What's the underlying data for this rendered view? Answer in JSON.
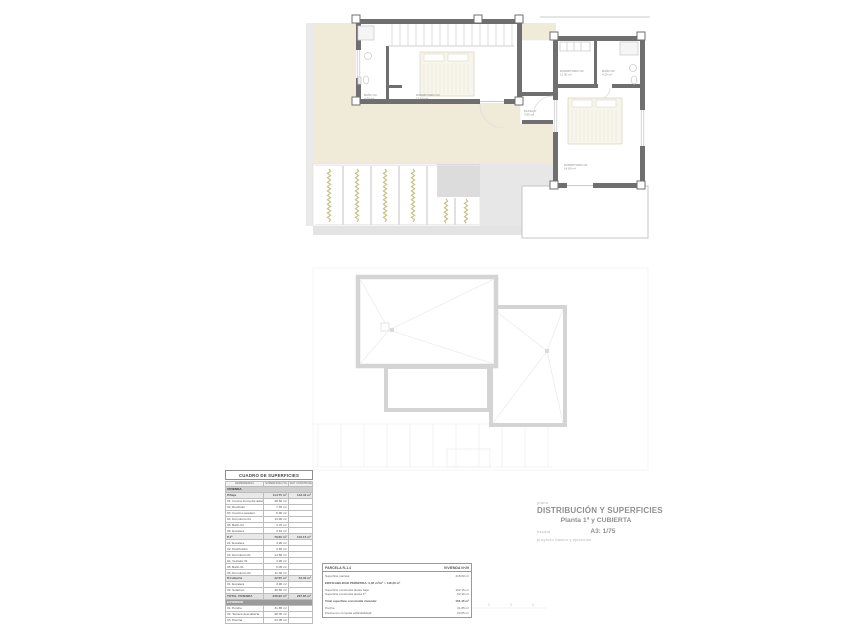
{
  "colors": {
    "wall_gray": "#6f6f6f",
    "terrace_beige": "#f0ebd9",
    "deck_gray": "#e3e3e3",
    "pergola_olive": "#c1bf7e",
    "roof_outline": "#d4d4d4",
    "text_gray": "#8f8f8f"
  },
  "floor_plan": {
    "labels": [
      {
        "text": "BAÑO 03",
        "area": "4.30 m²"
      },
      {
        "text": "DORMITORIO 03",
        "area": "12.60 m²"
      },
      {
        "text": "PASILLO",
        "area": "3.65 m²"
      },
      {
        "text": "DORMITORIO 02",
        "area": "11.30 m²"
      },
      {
        "text": "BAÑO 02",
        "area": "4.25 m²"
      },
      {
        "text": "DORMITORIO 01",
        "area": "14.80 m²"
      }
    ]
  },
  "scale_bar": {
    "ticks": [
      "1",
      "2",
      "3",
      "4"
    ]
  },
  "surfaces_table": {
    "title": "CUADRO DE SUPERFICIES",
    "col_dependencia": "DEPENDENCIA",
    "col_util": "SUPERFICIE ÚTIL",
    "col_construida": "SUP. CONSTRUIDA",
    "section_vivienda": "VIVIENDA",
    "rows": [
      {
        "label": "P.Baja",
        "util": "114.75 m²",
        "cons": "133.40 m²"
      },
      {
        "label": "01. Cocina-Comedor-Estar",
        "util": "48.60 m²",
        "cons": ""
      },
      {
        "label": "02. Recibidor",
        "util": "7.45 m²",
        "cons": ""
      },
      {
        "label": "03. Cuarto Lavadero",
        "util": "6.90 m²",
        "cons": ""
      },
      {
        "label": "04. Dormitorio 04",
        "util": "13.90 m²",
        "cons": ""
      },
      {
        "label": "05. Baño 04",
        "util": "4.70 m²",
        "cons": ""
      },
      {
        "label": "06. Escalera",
        "util": "4.10 m²",
        "cons": ""
      },
      {
        "label": "P.1ª",
        "util": "79.60 m²",
        "cons": "102.15 m²"
      },
      {
        "label": "01. Escalera",
        "util": "3.90 m²",
        "cons": ""
      },
      {
        "label": "02. Distribuidor",
        "util": "4.65 m²",
        "cons": ""
      },
      {
        "label": "03. Dormitorio 01",
        "util": "14.80 m²",
        "cons": ""
      },
      {
        "label": "04. Vestidor 01",
        "util": "4.90 m²",
        "cons": ""
      },
      {
        "label": "05. Baño 01",
        "util": "5.05 m²",
        "cons": ""
      },
      {
        "label": "06. Dormitorio 02",
        "util": "11.30 m²",
        "cons": ""
      },
      {
        "label": "P.Cubierta",
        "util": "42.55 m²",
        "cons": "52.30 m²"
      },
      {
        "label": "01. Escalera",
        "util": "3.90 m²",
        "cons": ""
      },
      {
        "label": "02. Solárium",
        "util": "38.65 m²",
        "cons": ""
      }
    ],
    "total_label": "TOTAL VIVIENDA",
    "total_util": "236.90 m²",
    "total_cons": "287.85 m²",
    "section_exterior": "EXTERIOR",
    "exterior_rows": [
      {
        "label": "01. Porche",
        "util": "31.85 m²"
      },
      {
        "label": "02. Terraza descubierta",
        "util": "48.35 m²"
      },
      {
        "label": "03. Piscina",
        "util": "23.05 m²"
      }
    ]
  },
  "parcel_table": {
    "parcela": "PARCELA R-1.4",
    "vivienda": "VIVIENDA Nº29",
    "parcela_row": {
      "label": "Superficie parcela:",
      "value": "418.00 m²"
    },
    "edificabilidad": "EDIFICABILIDAD PERMITIDA: 0,35 m²/m² = 146,30 m²",
    "construida_rows": [
      {
        "label": "Superficie construida planta baja:",
        "value": "102.15 m²"
      },
      {
        "label": "Superficie construida planta 1ª:",
        "value": "52.30 m²"
      }
    ],
    "total_label": "Total superficie construida vivienda:",
    "total_value": "154.45 m²",
    "extra_rows": [
      {
        "label": "Porche:",
        "value": "31.85 m²"
      },
      {
        "label": "Piscina (no computa edificabilidad):",
        "value": "23.05 m²"
      }
    ]
  },
  "title_block": {
    "label_plano": "plano",
    "title": "DISTRIBUCIÓN Y SUPERFICIES",
    "subtitle": "Planta 1ª y CUBIERTA",
    "label_escala": "escala",
    "scale_value": "A3: 1/75",
    "note": "proyecto básico y ejecución"
  }
}
